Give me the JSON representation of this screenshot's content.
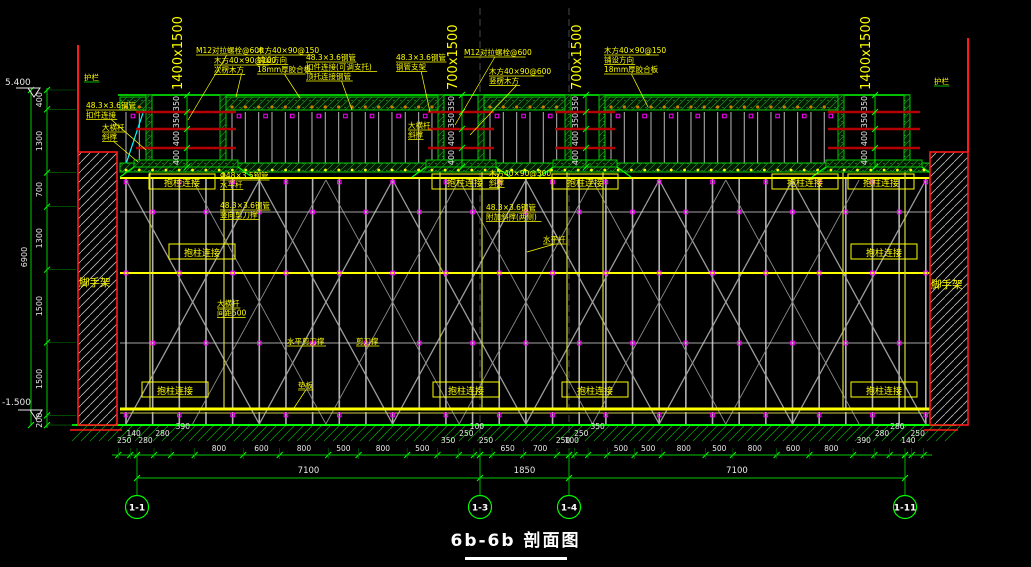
{
  "drawing": {
    "title": "6b-6b 剖面图",
    "elevation_top": "5.400",
    "elevation_bottom": "-1.500",
    "overall_height_dim": "6900",
    "left_dims": [
      "400",
      "1300",
      "700",
      "1300",
      "1500",
      "1500",
      "200"
    ],
    "guardrail_left": "护栏",
    "guardrail_right": "护栏",
    "wall_left": "脚手架",
    "wall_right": "脚手架",
    "beams": [
      {
        "label": "1400x1500",
        "dims": [
          "350",
          "350",
          "400",
          "400"
        ]
      },
      {
        "label": "700x1500",
        "dims": [
          "350",
          "350",
          "400",
          "400"
        ]
      },
      {
        "label": "700x1500",
        "dims": [
          "350",
          "350",
          "400",
          "400"
        ]
      },
      {
        "label": "1400x1500",
        "dims": [
          "350",
          "350",
          "400",
          "400"
        ]
      }
    ],
    "boxed_label": "抱柱连接",
    "boxed_positions": [
      [
        182,
        183
      ],
      [
        465,
        183
      ],
      [
        585,
        183
      ],
      [
        805,
        183
      ],
      [
        881,
        183
      ],
      [
        202,
        253
      ],
      [
        884,
        253
      ],
      [
        175,
        391
      ],
      [
        466,
        391
      ],
      [
        595,
        391
      ],
      [
        884,
        391
      ]
    ],
    "annotations": [
      {
        "x": 84,
        "y": 80,
        "lines": [
          "护栏"
        ],
        "ul": "green"
      },
      {
        "x": 934,
        "y": 84,
        "lines": [
          "护栏"
        ],
        "ul": "green"
      },
      {
        "x": 86,
        "y": 108,
        "lines": [
          "48.3×3.6钢管",
          "扣件连接"
        ],
        "leader": [
          146,
          150
        ]
      },
      {
        "x": 102,
        "y": 130,
        "lines": [
          "大横杆",
          "斜撑"
        ],
        "leader": [
          138,
          162
        ]
      },
      {
        "x": 196,
        "y": 53,
        "lines": [
          "M12对拉螺栓@600"
        ],
        "leader": [
          188,
          120
        ]
      },
      {
        "x": 214,
        "y": 63,
        "lines": [
          "木方40×90@100",
          "次楞木方"
        ],
        "leader": [
          236,
          97
        ]
      },
      {
        "x": 257,
        "y": 53,
        "lines": [
          "木方40×90@150",
          "铺设方向",
          "18mm厚胶合板"
        ],
        "leader": [
          300,
          98
        ]
      },
      {
        "x": 306,
        "y": 60,
        "lines": [
          "48.3×3.6钢管",
          "扣件连接(可调支托)",
          "顶托连接钢管"
        ],
        "leader": [
          352,
          110
        ]
      },
      {
        "x": 396,
        "y": 60,
        "lines": [
          "48.3×3.6钢管",
          "钢管支架"
        ],
        "leader": [
          430,
          112
        ]
      },
      {
        "x": 464,
        "y": 55,
        "lines": [
          "M12对拉螺栓@600"
        ],
        "leader": [
          455,
          125
        ]
      },
      {
        "x": 489,
        "y": 74,
        "lines": [
          "木方40×90@600",
          "竖楞木方"
        ],
        "leader": [
          470,
          135
        ]
      },
      {
        "x": 604,
        "y": 53,
        "lines": [
          "木方40×90@150",
          "铺设方向",
          "18mm厚胶合板"
        ],
        "leader": [
          648,
          107
        ]
      },
      {
        "x": 408,
        "y": 128,
        "lines": [
          "大横杆",
          "斜撑"
        ]
      },
      {
        "x": 220,
        "y": 178,
        "lines": [
          "Φ48×3.5钢管",
          "水平杆"
        ]
      },
      {
        "x": 220,
        "y": 208,
        "lines": [
          "48.3×3.6钢管",
          "竖向剪刀撑"
        ]
      },
      {
        "x": 489,
        "y": 176,
        "lines": [
          "木方40×90@300",
          "斜撑"
        ]
      },
      {
        "x": 486,
        "y": 210,
        "lines": [
          "48.3×3.6钢管",
          "附加斜撑(两侧)"
        ]
      },
      {
        "x": 543,
        "y": 242,
        "lines": [
          "水平杆"
        ],
        "leader": [
          527,
          252
        ]
      },
      {
        "x": 217,
        "y": 306,
        "lines": [
          "大横杆",
          "间距500"
        ]
      },
      {
        "x": 287,
        "y": 344,
        "lines": [
          "水平剪刀撑"
        ]
      },
      {
        "x": 356,
        "y": 344,
        "lines": [
          "剪刀撑"
        ]
      },
      {
        "x": 298,
        "y": 388,
        "lines": [
          "垫板"
        ],
        "leader": [
          294,
          408
        ]
      }
    ],
    "bottom": {
      "pre": [
        "250",
        "140"
      ],
      "left_group": [
        "280",
        "280",
        "390",
        "800",
        "600",
        "800",
        "500",
        "800",
        "500",
        "350",
        "250",
        "100"
      ],
      "center_group": [
        "250",
        "650",
        "700",
        "250"
      ],
      "right_group": [
        "100",
        "250",
        "350",
        "500",
        "500",
        "800",
        "500",
        "800",
        "600",
        "800",
        "390",
        "280",
        "280"
      ],
      "post": [
        "140",
        "250"
      ],
      "overalls": [
        "7100",
        "1850",
        "7100"
      ],
      "grids": [
        "1-1",
        "1-3",
        "1-4",
        "1-11"
      ]
    }
  },
  "colors": {
    "background": "#000000",
    "green": "#00c800",
    "bright_green": "#00ff00",
    "yellow": "#ffff00",
    "dim_yellow": "#d6d640",
    "red": "#ff1a1a",
    "dark_red": "#b40000",
    "magenta": "#ff00ff",
    "gray": "#a8a8a8",
    "white": "#e8e8e8",
    "cyan": "#00ffff"
  }
}
